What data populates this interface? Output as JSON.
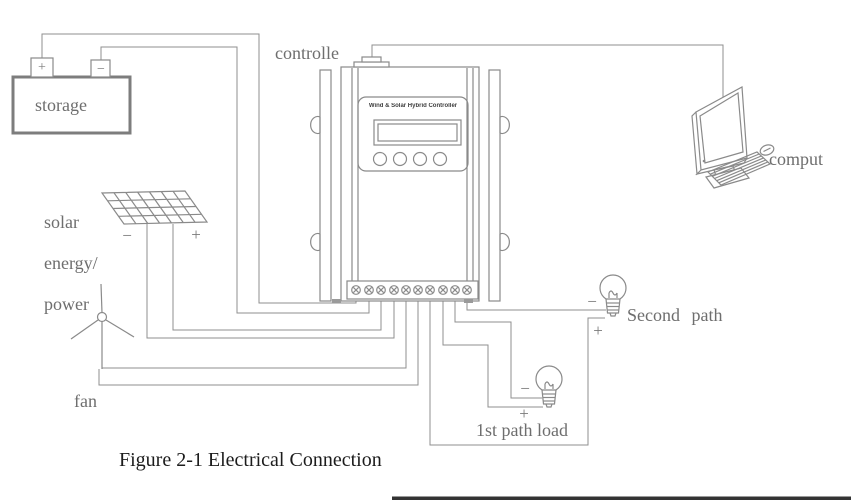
{
  "figure": {
    "caption": "Figure 2-1 Electrical Connection"
  },
  "labels": {
    "controller": "controlle",
    "storage": "storage",
    "solar_line1": "solar",
    "solar_line2": "energy/",
    "solar_line3": "power",
    "fan": "fan",
    "computer": "comput",
    "second_path": "Second path",
    "first_path_load": "1st path load"
  },
  "controller_device": {
    "title": "Wind & Solar Hybrid Controller"
  },
  "polarity": {
    "battery_plus": "+",
    "battery_minus": "−",
    "solar_plus": "+",
    "solar_minus": "−",
    "second_path_plus": "+",
    "second_path_minus": "−",
    "first_path_plus": "+",
    "first_path_minus": "−"
  },
  "colors": {
    "line": "#8a8a8a",
    "label_text": "#6e6e6e",
    "caption_text": "#1c1c1c",
    "lcd_fill": "#eef2ef",
    "screen_fill": "#e9f2f8",
    "bottom_bar": "#333333"
  }
}
